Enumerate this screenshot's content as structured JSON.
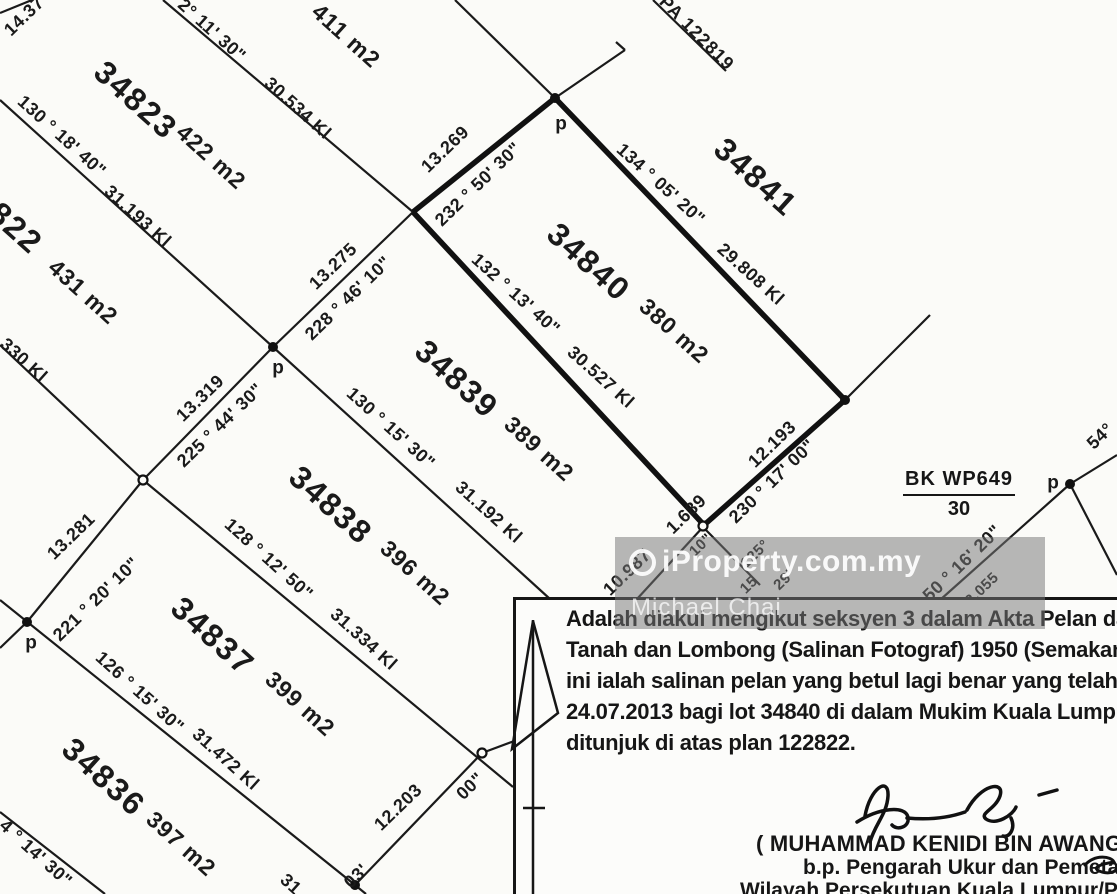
{
  "watermark": {
    "brand": "iProperty.com.my",
    "user": "Michael Chai"
  },
  "reference": {
    "block": "BK WP649",
    "sheet": "30"
  },
  "certificate": {
    "lines": [
      "Adalah diakui mengikut seksyen 3 dalam Akta Pelan dan Dokum",
      "Tanah dan Lombong (Salinan Fotograf) 1950 (Semakan 1980), baha",
      "ini ialah salinan pelan yang betul lagi benar yang telah dibuat pa",
      "24.07.2013 bagi lot 34840 di dalam Mukim  Kuala Lumpur sepe",
      "ditunjuk di atas plan 122822."
    ]
  },
  "signature": {
    "name": "( MUHAMMAD KENIDI BIN AWANG AZIZ",
    "role": "b.p. Pengarah Ukur dan Pemetaan",
    "office": "Wilayah Persekutuan Kuala Lumpur/Putraja"
  },
  "map": {
    "ink": "#1a1a1a",
    "labels": [
      {
        "text": "34823",
        "x": 136,
        "y": 100,
        "rot": 42,
        "kind": "lot"
      },
      {
        "text": "34841",
        "x": 756,
        "y": 177,
        "rot": 42,
        "kind": "lot"
      },
      {
        "text": "34840",
        "x": 589,
        "y": 262,
        "rot": 42,
        "kind": "lot"
      },
      {
        "text": "34839",
        "x": 457,
        "y": 379,
        "rot": 42,
        "kind": "lot"
      },
      {
        "text": "34838",
        "x": 331,
        "y": 505,
        "rot": 42,
        "kind": "lot"
      },
      {
        "text": "34837",
        "x": 213,
        "y": 636,
        "rot": 42,
        "kind": "lot"
      },
      {
        "text": "34836",
        "x": 104,
        "y": 777,
        "rot": 42,
        "kind": "lot"
      },
      {
        "text": "822",
        "x": 16,
        "y": 228,
        "rot": 42,
        "kind": "lot"
      },
      {
        "text": "422 m2",
        "x": 211,
        "y": 157,
        "rot": 42,
        "kind": "area"
      },
      {
        "text": "411 m2",
        "x": 346,
        "y": 36,
        "rot": 42,
        "kind": "area"
      },
      {
        "text": "431 m2",
        "x": 83,
        "y": 292,
        "rot": 42,
        "kind": "area"
      },
      {
        "text": "380 m2",
        "x": 674,
        "y": 331,
        "rot": 42,
        "kind": "area"
      },
      {
        "text": "389 m2",
        "x": 539,
        "y": 449,
        "rot": 42,
        "kind": "area"
      },
      {
        "text": "396 m2",
        "x": 415,
        "y": 573,
        "rot": 42,
        "kind": "area"
      },
      {
        "text": "399 m2",
        "x": 300,
        "y": 704,
        "rot": 42,
        "kind": "area"
      },
      {
        "text": "397 m2",
        "x": 181,
        "y": 844,
        "rot": 42,
        "kind": "area"
      },
      {
        "text": "2° 11' 30\"",
        "x": 212,
        "y": 30,
        "rot": 42,
        "kind": "bearing"
      },
      {
        "text": "30.534 Kl",
        "x": 298,
        "y": 108,
        "rot": 42,
        "kind": "bearing"
      },
      {
        "text": "130 ° 18' 40\"",
        "x": 62,
        "y": 136,
        "rot": 42,
        "kind": "bearing"
      },
      {
        "text": "31.193 Kl",
        "x": 138,
        "y": 216,
        "rot": 42,
        "kind": "bearing"
      },
      {
        "text": "134 ° 05' 20\"",
        "x": 661,
        "y": 184,
        "rot": 42,
        "kind": "bearing"
      },
      {
        "text": "29.808 Kl",
        "x": 751,
        "y": 274,
        "rot": 42,
        "kind": "bearing"
      },
      {
        "text": "132 ° 13' 40\"",
        "x": 516,
        "y": 294,
        "rot": 42,
        "kind": "bearing"
      },
      {
        "text": "30.527 Kl",
        "x": 601,
        "y": 377,
        "rot": 42,
        "kind": "bearing"
      },
      {
        "text": "130 ° 15' 30\"",
        "x": 391,
        "y": 428,
        "rot": 42,
        "kind": "bearing"
      },
      {
        "text": "31.192 Kl",
        "x": 489,
        "y": 512,
        "rot": 42,
        "kind": "bearing"
      },
      {
        "text": "128 ° 12' 50\"",
        "x": 269,
        "y": 559,
        "rot": 42,
        "kind": "bearing"
      },
      {
        "text": "31.334 Kl",
        "x": 364,
        "y": 639,
        "rot": 42,
        "kind": "bearing"
      },
      {
        "text": "126 ° 15' 30\"",
        "x": 140,
        "y": 692,
        "rot": 42,
        "kind": "bearing"
      },
      {
        "text": "31.472 Kl",
        "x": 226,
        "y": 759,
        "rot": 42,
        "kind": "bearing"
      },
      {
        "text": "330 Kl",
        "x": 24,
        "y": 360,
        "rot": 42,
        "kind": "bearing"
      },
      {
        "text": "4 ° 14' 30\"",
        "x": 36,
        "y": 853,
        "rot": 42,
        "kind": "bearing"
      },
      {
        "text": "31",
        "x": 291,
        "y": 884,
        "rot": 42,
        "kind": "bearing"
      },
      {
        "text": "PA 122819",
        "x": 697,
        "y": 33,
        "rot": 45,
        "kind": "plan-ref"
      },
      {
        "text": "14.37",
        "x": 24,
        "y": 16,
        "rot": -44,
        "kind": "bearing"
      },
      {
        "text": "13.269",
        "x": 445,
        "y": 149,
        "rot": -44,
        "kind": "bearing"
      },
      {
        "text": "232 ° 50' 30\"",
        "x": 478,
        "y": 184,
        "rot": -44,
        "kind": "bearing"
      },
      {
        "text": "13.275",
        "x": 333,
        "y": 266,
        "rot": -44,
        "kind": "bearing"
      },
      {
        "text": "228 ° 46' 10\"",
        "x": 348,
        "y": 298,
        "rot": -44,
        "kind": "bearing"
      },
      {
        "text": "13.319",
        "x": 200,
        "y": 398,
        "rot": -44,
        "kind": "bearing"
      },
      {
        "text": "225 ° 44' 30\"",
        "x": 220,
        "y": 425,
        "rot": -44,
        "kind": "bearing"
      },
      {
        "text": "13.281",
        "x": 71,
        "y": 536,
        "rot": -44,
        "kind": "bearing"
      },
      {
        "text": "221 ° 20' 10\"",
        "x": 96,
        "y": 599,
        "rot": -44,
        "kind": "bearing"
      },
      {
        "text": "12.193",
        "x": 772,
        "y": 444,
        "rot": -44,
        "kind": "bearing"
      },
      {
        "text": "230 ° 17' 00\"",
        "x": 772,
        "y": 481,
        "rot": -44,
        "kind": "bearing"
      },
      {
        "text": "1.689",
        "x": 686,
        "y": 514,
        "rot": -44,
        "kind": "bearing"
      },
      {
        "text": "12.203",
        "x": 398,
        "y": 807,
        "rot": -44,
        "kind": "bearing"
      },
      {
        "text": "00\"",
        "x": 470,
        "y": 786,
        "rot": -44,
        "kind": "bearing"
      },
      {
        "text": "03'",
        "x": 356,
        "y": 876,
        "rot": -44,
        "kind": "bearing"
      },
      {
        "text": "54°",
        "x": 1100,
        "y": 436,
        "rot": -44,
        "kind": "bearing"
      },
      {
        "text": "50 ° 16' 20\"",
        "x": 962,
        "y": 563,
        "rot": -44,
        "kind": "bearing"
      },
      {
        "text": "2.055",
        "x": 982,
        "y": 589,
        "rot": -44,
        "kind": "frag"
      },
      {
        "text": "10.987",
        "x": 627,
        "y": 572,
        "rot": -44,
        "kind": "bearing"
      },
      {
        "text": "10\"",
        "x": 701,
        "y": 545,
        "rot": -44,
        "kind": "frag"
      },
      {
        "text": "125°",
        "x": 755,
        "y": 554,
        "rot": -44,
        "kind": "frag"
      },
      {
        "text": "15",
        "x": 749,
        "y": 585,
        "rot": -44,
        "kind": "frag"
      },
      {
        "text": "29'",
        "x": 784,
        "y": 580,
        "rot": -44,
        "kind": "frag"
      },
      {
        "text": "p",
        "x": 561,
        "y": 124,
        "rot": 0,
        "kind": "p"
      },
      {
        "text": "p",
        "x": 278,
        "y": 368,
        "rot": 0,
        "kind": "p"
      },
      {
        "text": "p",
        "x": 31,
        "y": 643,
        "rot": 0,
        "kind": "p"
      },
      {
        "text": "p",
        "x": 1053,
        "y": 483,
        "rot": 0,
        "kind": "p"
      }
    ],
    "lines": [
      [
        163,
        0,
        413,
        212
      ],
      [
        455,
        0,
        555,
        98
      ],
      [
        625,
        50,
        555,
        98
      ],
      [
        625,
        50,
        616,
        42
      ],
      [
        413,
        212,
        273,
        347
      ],
      [
        273,
        347,
        143,
        480
      ],
      [
        143,
        480,
        27,
        622
      ],
      [
        27,
        622,
        0,
        648
      ],
      [
        0,
        100,
        273,
        347
      ],
      [
        273,
        347,
        550,
        599
      ],
      [
        0,
        345,
        143,
        480
      ],
      [
        143,
        480,
        513,
        787
      ],
      [
        0,
        600,
        355,
        885
      ],
      [
        355,
        885,
        366,
        894
      ],
      [
        355,
        885,
        482,
        753
      ],
      [
        482,
        753,
        517,
        740
      ],
      [
        0,
        812,
        105,
        894
      ],
      [
        845,
        400,
        930,
        315
      ],
      [
        703,
        527,
        637,
        599
      ],
      [
        703,
        527,
        760,
        585
      ],
      [
        1070,
        484,
        1117,
        455
      ],
      [
        1070,
        484,
        1117,
        575
      ],
      [
        1070,
        484,
        940,
        600
      ],
      [
        653,
        0,
        726,
        71
      ],
      [
        0,
        13,
        32,
        0
      ]
    ],
    "bold_lines": [
      [
        555,
        98,
        413,
        212
      ],
      [
        413,
        212,
        703,
        524
      ],
      [
        703,
        526,
        845,
        400
      ],
      [
        555,
        98,
        845,
        400
      ]
    ],
    "circles": [
      [
        143,
        480
      ],
      [
        482,
        753
      ],
      [
        703,
        526
      ]
    ],
    "dots": [
      [
        555,
        98
      ],
      [
        845,
        400
      ],
      [
        273,
        347
      ],
      [
        27,
        622
      ],
      [
        355,
        885
      ],
      [
        1070,
        484
      ]
    ]
  }
}
